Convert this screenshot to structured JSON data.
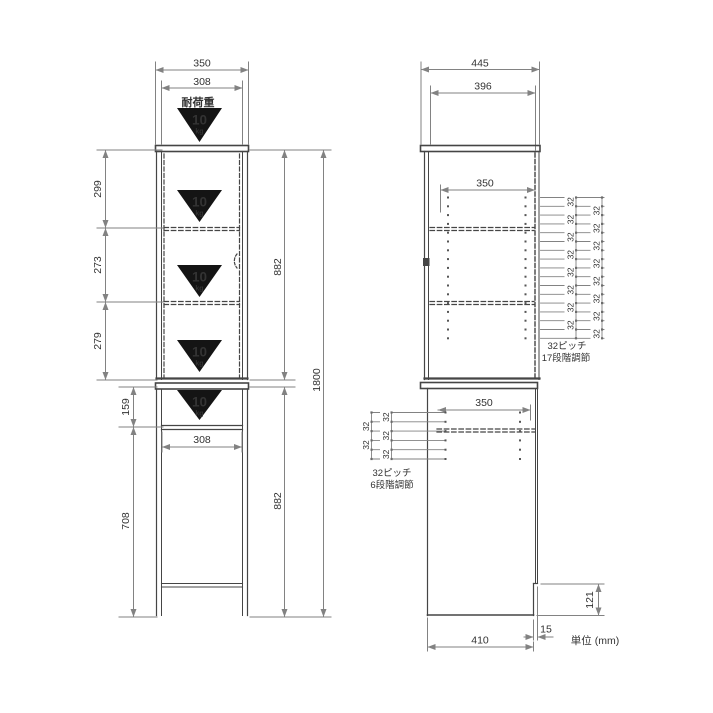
{
  "front_view": {
    "load_label": "耐荷重",
    "load_badge": {
      "value": "10",
      "unit": "kg"
    },
    "dims": {
      "top_width": "350",
      "inner_width": "308",
      "section1": "299",
      "section2": "273",
      "section3": "279",
      "upper_height": "882",
      "total_height": "1800",
      "lower_top_height": "159",
      "lower_inner_width": "308",
      "lower_open_height": "708",
      "lower_height": "882"
    }
  },
  "side_view": {
    "dims": {
      "total_depth": "445",
      "inner_depth": "396",
      "upper_shelf_depth": "350",
      "lower_shelf_depth": "350",
      "kick_height": "121",
      "front_offset": "15",
      "base_depth": "410"
    },
    "pitch_upper": {
      "value": "32",
      "positions": 17,
      "note_line1": "32ピッチ",
      "note_line2": "17段階調節"
    },
    "pitch_lower": {
      "value": "32",
      "positions": 6,
      "note_line1": "32ピッチ",
      "note_line2": "6段階調節"
    }
  },
  "footer": {
    "unit_note": "単位 (mm)"
  },
  "colors": {
    "background": "#ffffff",
    "outline": "#454545",
    "dim_line": "#828282",
    "text": "#333333",
    "badge": "#141414",
    "badge_text": "#ffffff"
  }
}
